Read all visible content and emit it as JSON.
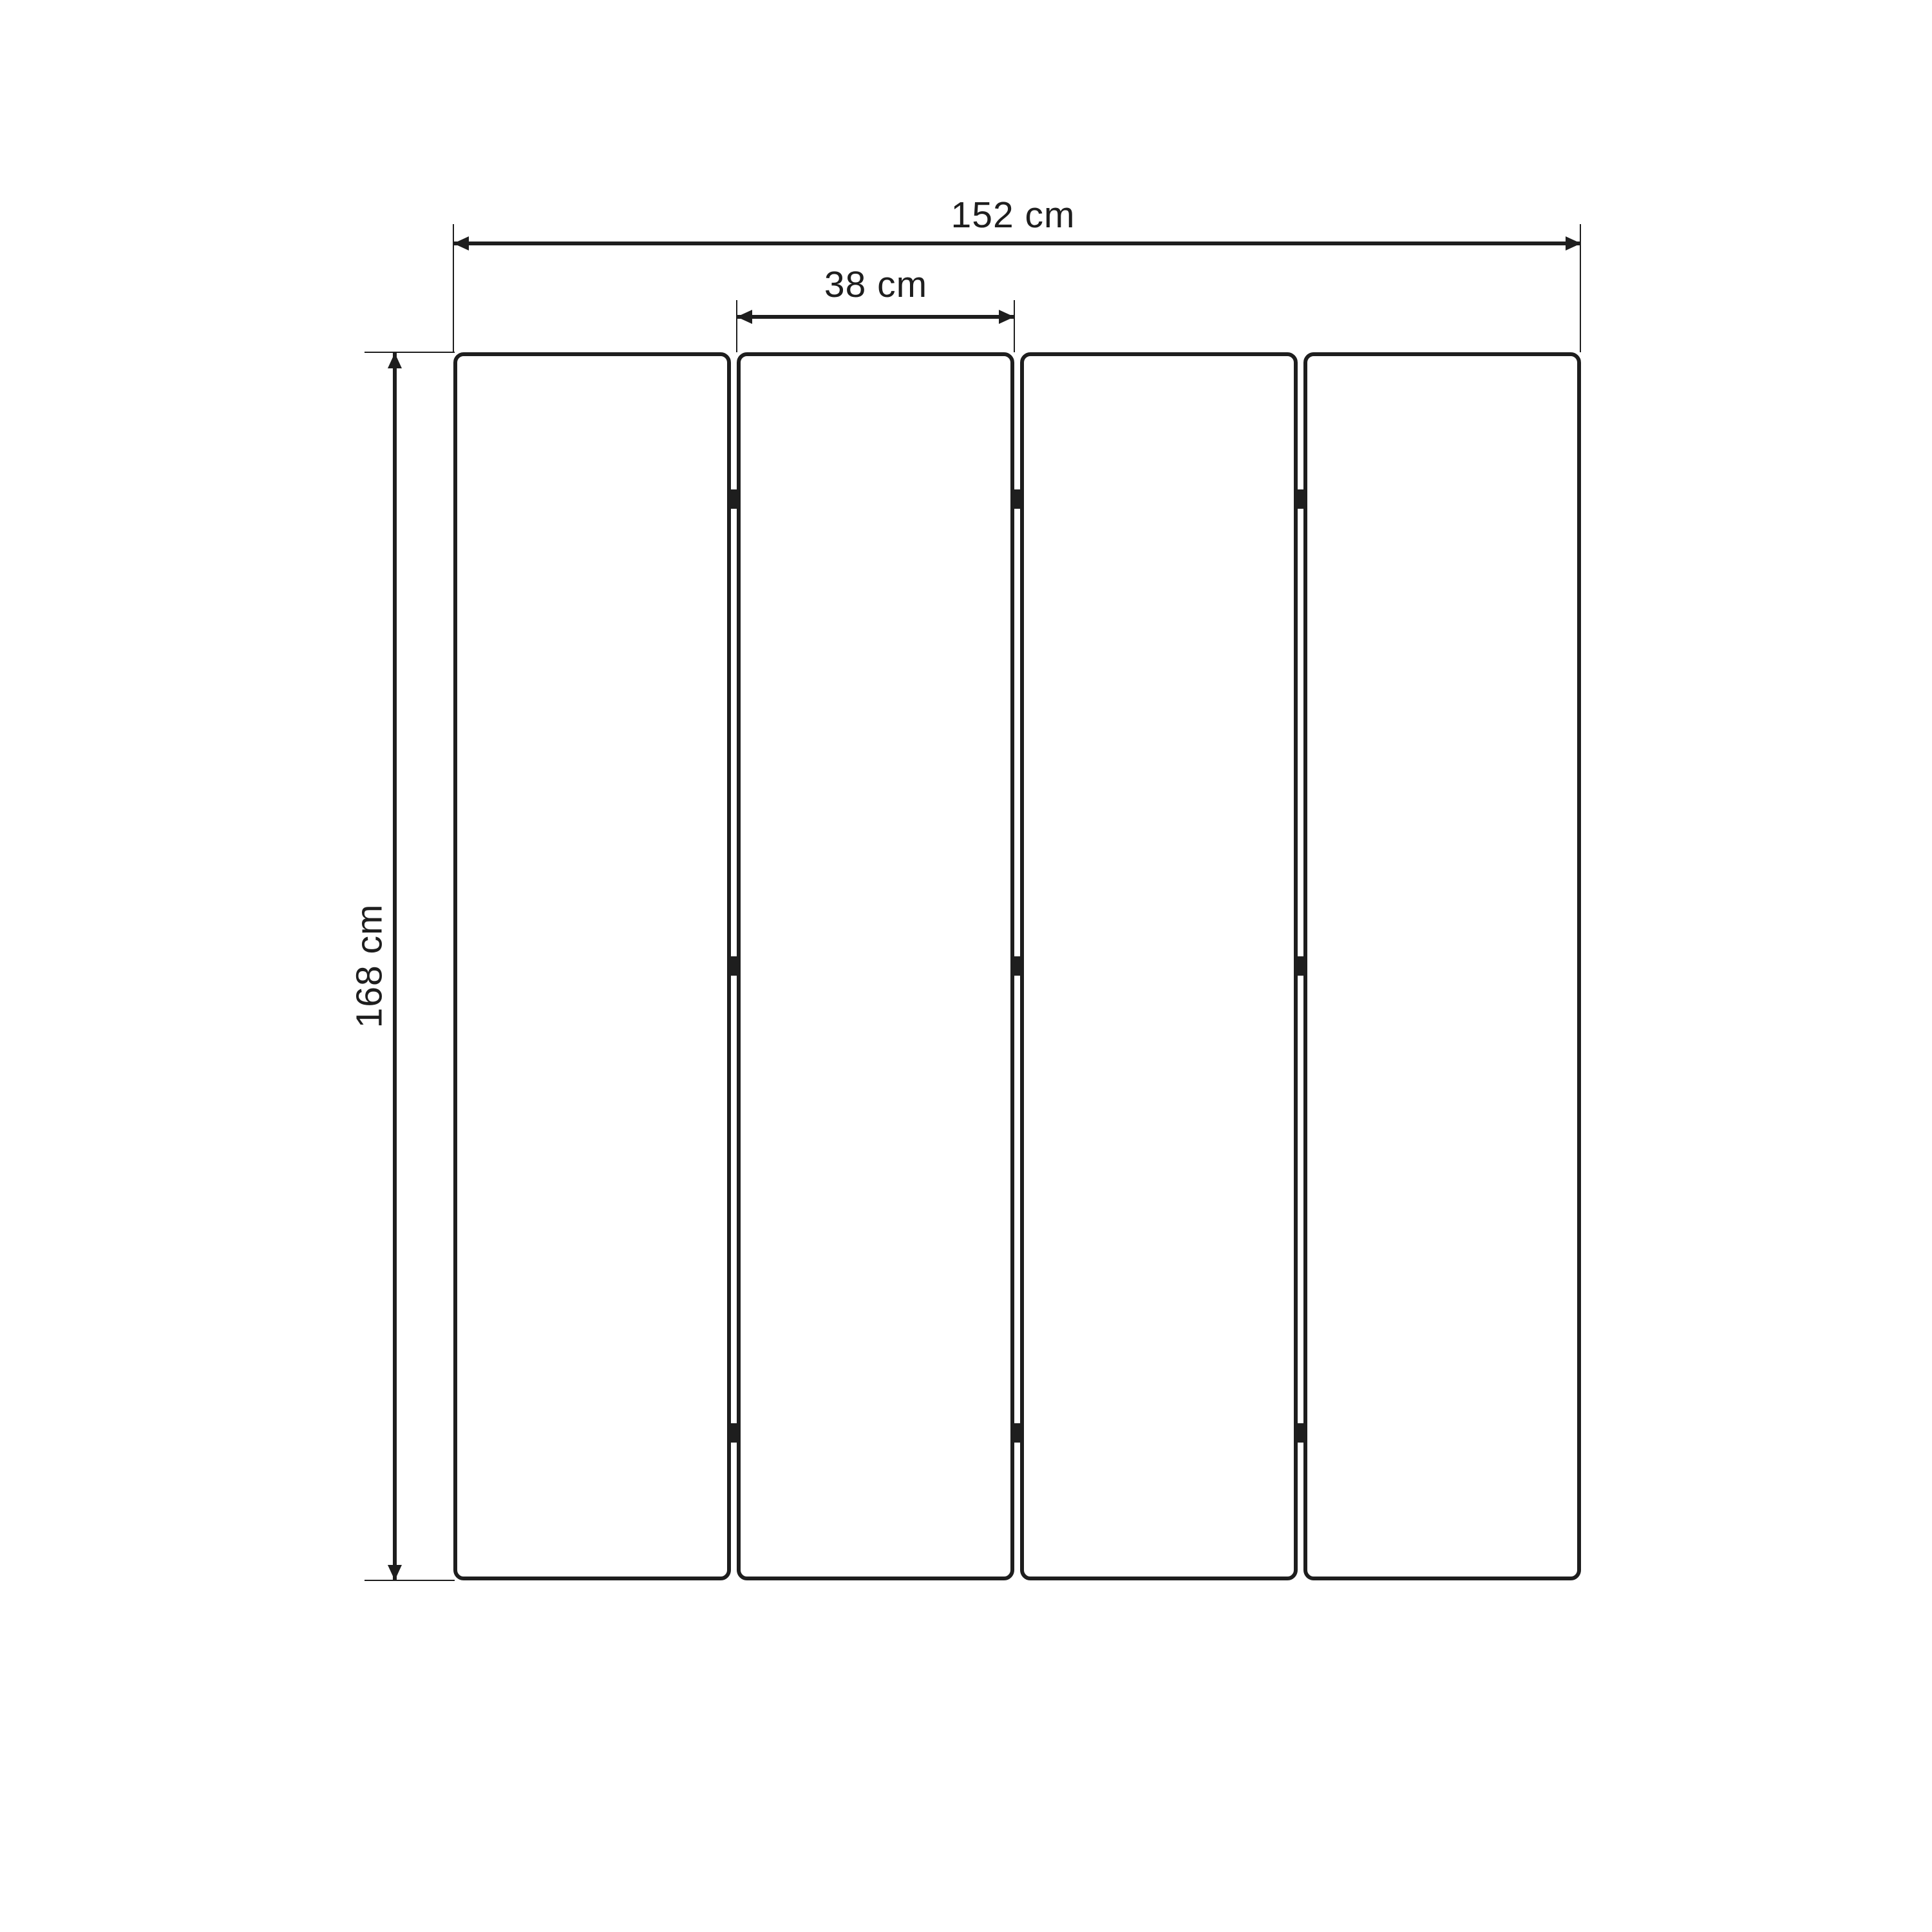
{
  "diagram": {
    "background_color": "#ffffff",
    "line_color": "#1e1e1e",
    "panels": {
      "count": 4,
      "gaps": 3,
      "hinge_rows_per_gap": 3
    },
    "dimensions": {
      "total_width": {
        "label": "152 cm",
        "value": 152,
        "unit": "cm"
      },
      "panel_width": {
        "label": "38 cm",
        "value": 38,
        "unit": "cm"
      },
      "height": {
        "label": "168 cm",
        "value": 168,
        "unit": "cm"
      }
    }
  }
}
